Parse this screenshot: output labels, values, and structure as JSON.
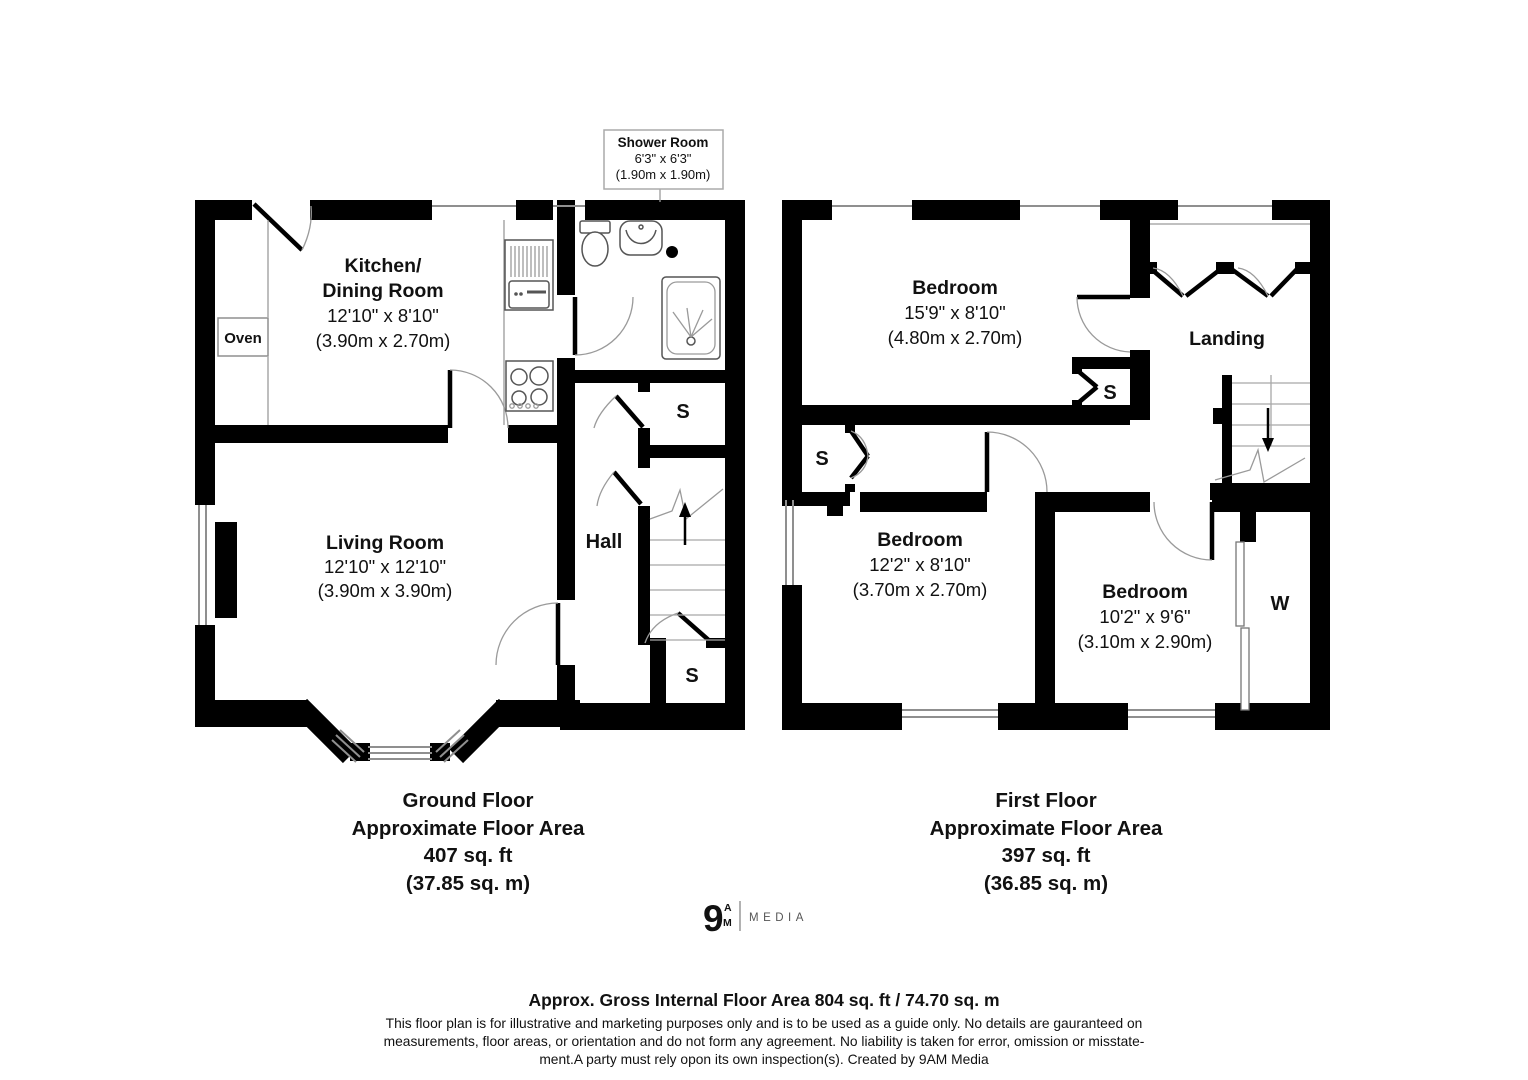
{
  "shower": {
    "title": "Shower Room",
    "dims": "6'3\" x 6'3\"",
    "metric": "(1.90m x 1.90m)"
  },
  "ground": {
    "kitchen": {
      "l1": "Kitchen/",
      "l2": "Dining Room",
      "dims": "12'10\" x 8'10\"",
      "metric": "(3.90m x 2.70m)"
    },
    "living": {
      "name": "Living Room",
      "dims": "12'10\" x 12'10\"",
      "metric": "(3.90m x 3.90m)"
    },
    "hall": "Hall",
    "oven": "Oven",
    "s1": "S",
    "s2": "S",
    "title": [
      "Ground Floor",
      "Approximate Floor Area",
      "407 sq. ft",
      "(37.85 sq. m)"
    ]
  },
  "first": {
    "bed1": {
      "name": "Bedroom",
      "dims": "15'9\" x 8'10\"",
      "metric": "(4.80m x 2.70m)"
    },
    "bed2": {
      "name": "Bedroom",
      "dims": "12'2\" x 8'10\"",
      "metric": "(3.70m x 2.70m)"
    },
    "bed3": {
      "name": "Bedroom",
      "dims": "10'2\" x 9'6\"",
      "metric": "(3.10m x 2.90m)"
    },
    "landing": "Landing",
    "s1": "S",
    "s2": "S",
    "w": "W",
    "title": [
      "First Floor",
      "Approximate Floor Area",
      "397 sq. ft",
      "(36.85 sq. m)"
    ]
  },
  "logo": {
    "numeral": "9",
    "a": "A",
    "m": "M",
    "word": "MEDIA"
  },
  "colors": {
    "accent": "#E8462C",
    "wall": "#000000",
    "muted": "#555555"
  },
  "footer": {
    "headline": "Approx. Gross Internal Floor Area 804 sq. ft / 74.70 sq. m",
    "line1": "This floor plan is for illustrative and marketing purposes only and is to be used as a guide only. No details are gauranteed on",
    "line2": "measurements, floor areas, or orientation and do not form any agreement. No liability is taken for error, omission or misstate-",
    "line3": "ment.A party must rely opon its own inspection(s). Created by 9AM Media"
  }
}
